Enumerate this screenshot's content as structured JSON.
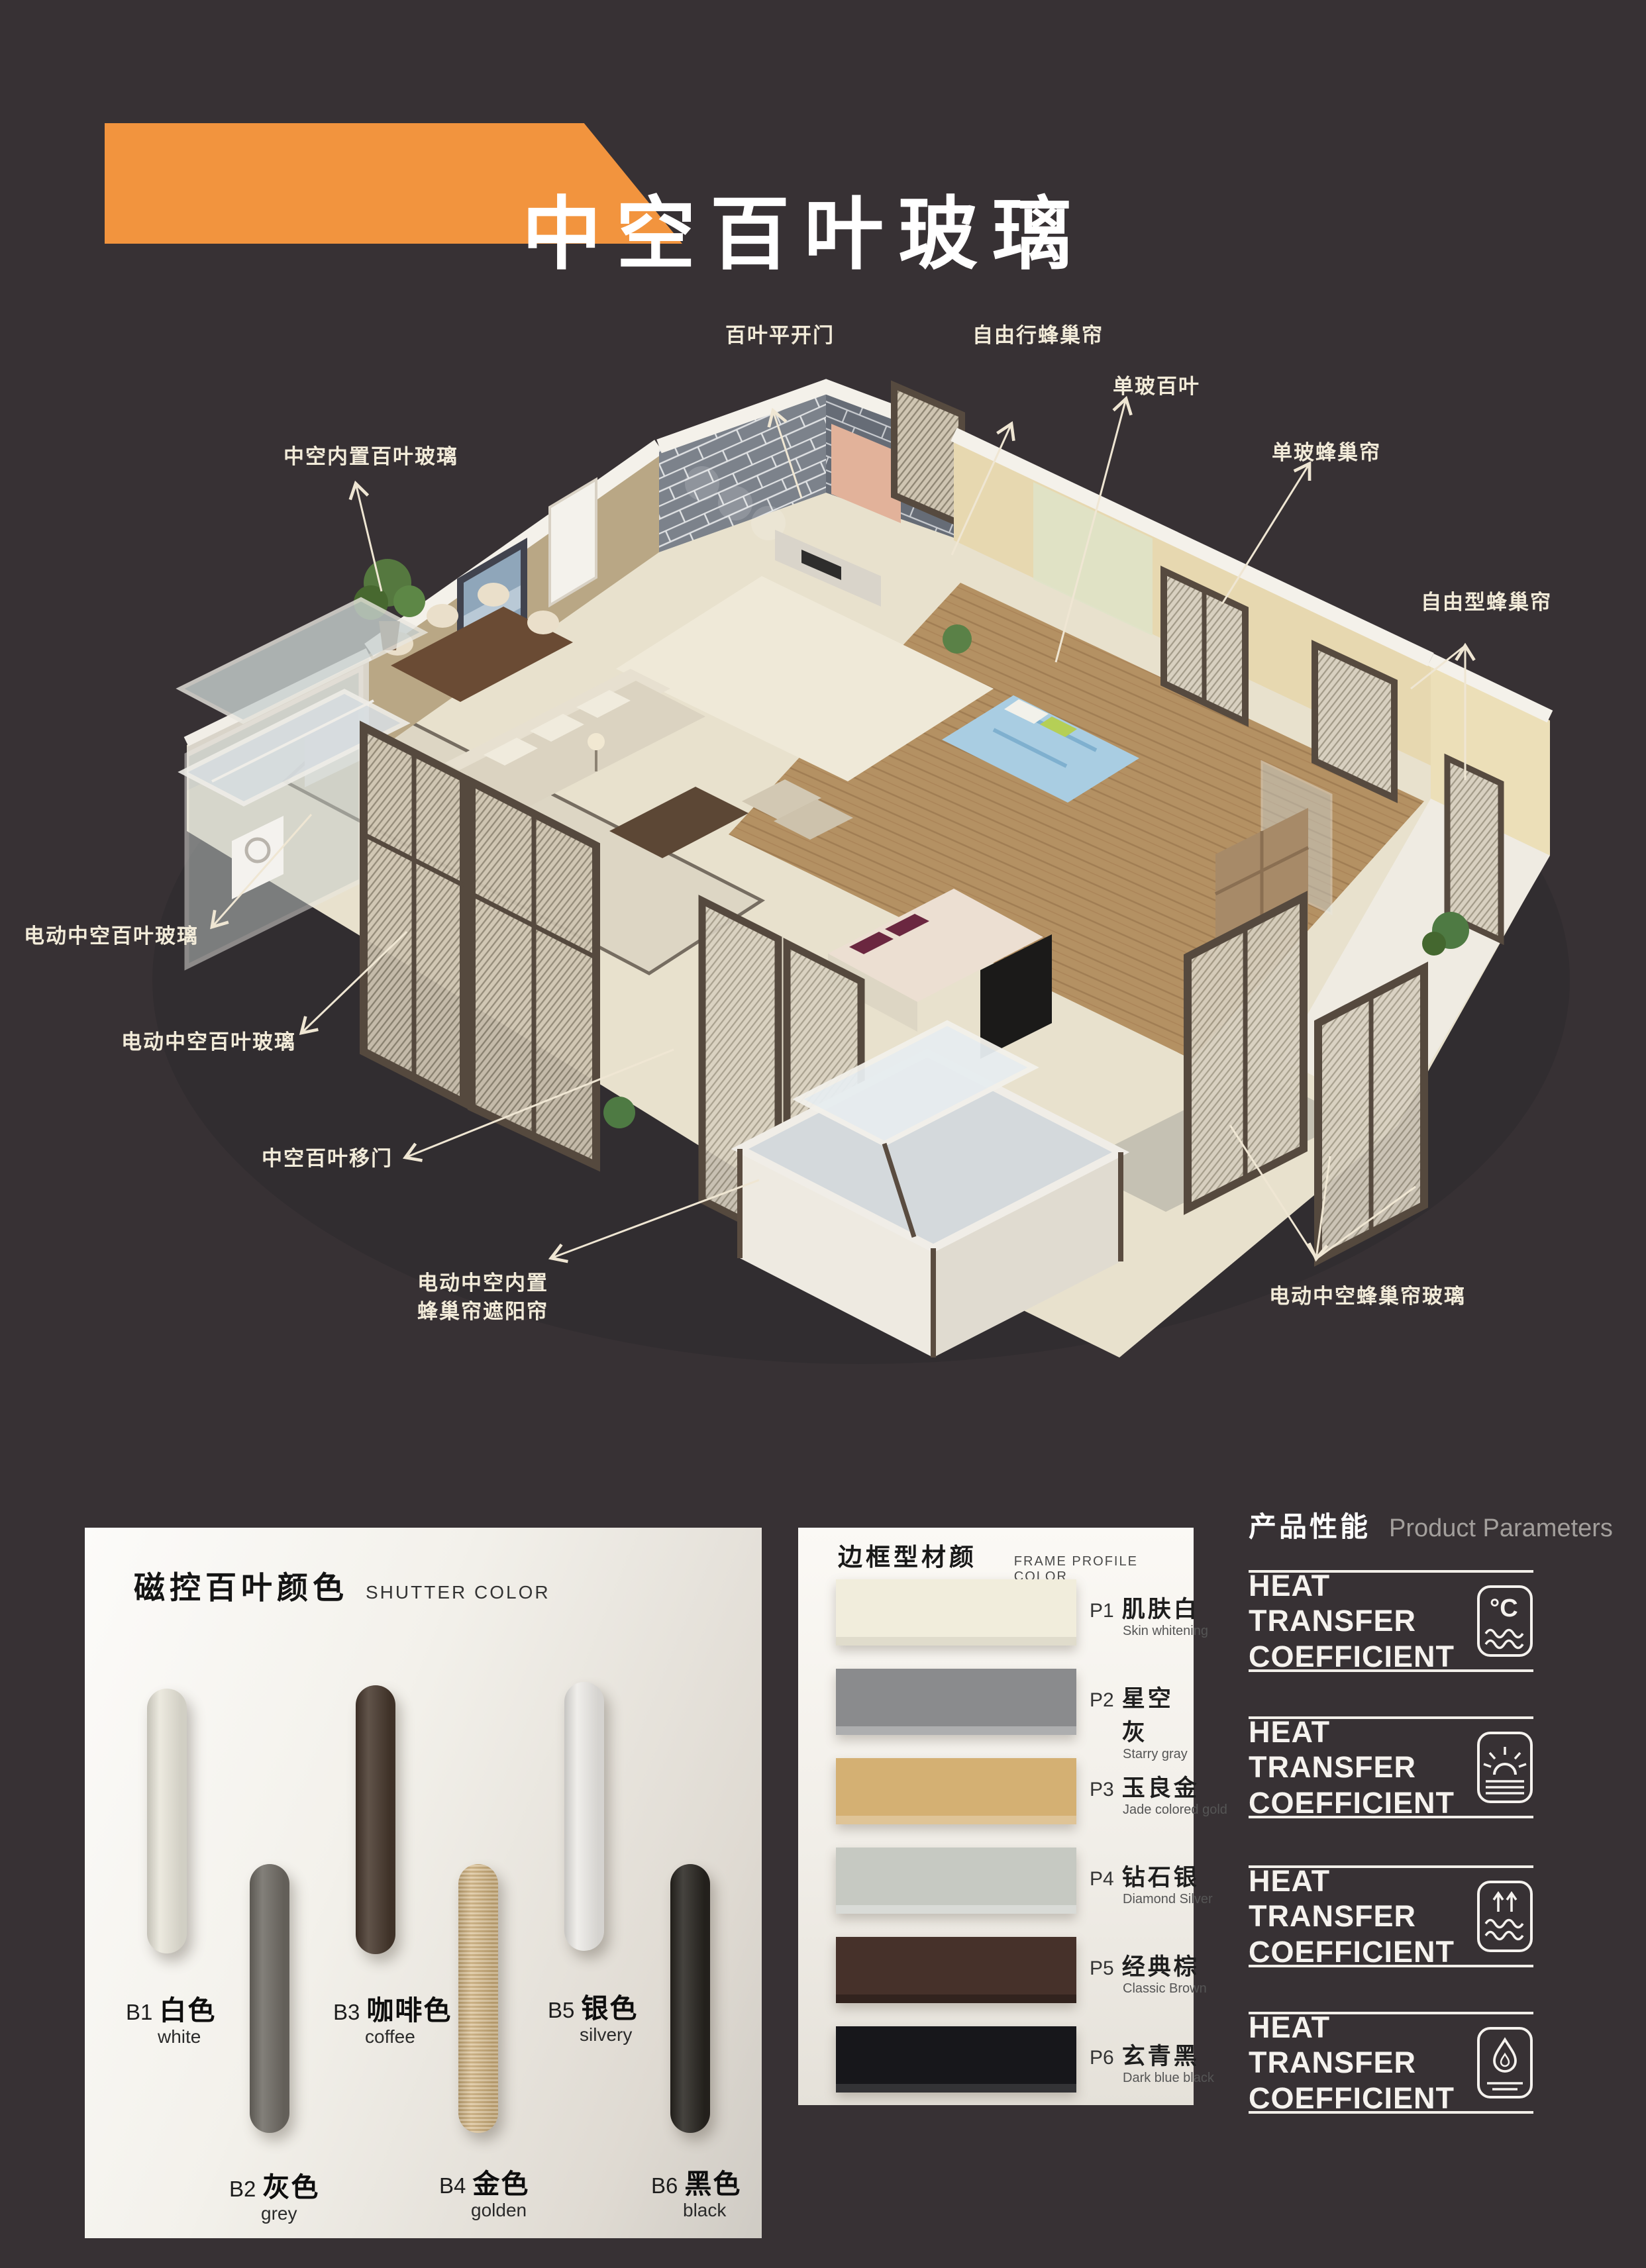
{
  "colors": {
    "background": "#373134",
    "banner_orange": "#f2943e",
    "callout_text": "#f2ebd9",
    "leader_line": "#efe6d3"
  },
  "banner": {
    "title": "中空百叶玻璃"
  },
  "callouts": [
    {
      "label": "百叶平开门"
    },
    {
      "label": "自由行蜂巢帘"
    },
    {
      "label": "单玻百叶"
    },
    {
      "label": "单玻蜂巢帘"
    },
    {
      "label": "中空内置百叶玻璃"
    },
    {
      "label": "自由型蜂巢帘"
    },
    {
      "label": "电动中空百叶玻璃"
    },
    {
      "label": "电动中空百叶玻璃"
    },
    {
      "label": "中空百叶移门"
    },
    {
      "label": "电动中空内置",
      "label2": "蜂巢帘遮阳帘"
    },
    {
      "label": "电动中空蜂巢帘玻璃"
    }
  ],
  "shutter_panel": {
    "title_zh": "磁控百叶颜色",
    "title_en": "SHUTTER COLOR",
    "items": [
      {
        "code": "B1",
        "name_zh": "白色",
        "name_en": "white",
        "color": "#e9e6da"
      },
      {
        "code": "B2",
        "name_zh": "灰色",
        "name_en": "grey",
        "color": "#6e6a63"
      },
      {
        "code": "B3",
        "name_zh": "咖啡色",
        "name_en": "coffee",
        "color": "#46372c"
      },
      {
        "code": "B4",
        "name_zh": "金色",
        "name_en": "golden",
        "color": "#d5b887"
      },
      {
        "code": "B5",
        "name_zh": "银色",
        "name_en": "silvery",
        "color": "#edebe7"
      },
      {
        "code": "B6",
        "name_zh": "黑色",
        "name_en": "black",
        "color": "#27241f"
      }
    ]
  },
  "frame_panel": {
    "title_zh": "边框型材颜色",
    "title_en": "FRAME PROFILE COLOR",
    "items": [
      {
        "code": "P1",
        "name_zh": "肌肤白",
        "name_en": "Skin whitening",
        "color": "#f1eddc"
      },
      {
        "code": "P2",
        "name_zh": "星空灰",
        "name_en": "Starry gray",
        "color": "#8a8b8d"
      },
      {
        "code": "P3",
        "name_zh": "玉良金",
        "name_en": "Jade colored gold",
        "color": "#d4b073"
      },
      {
        "code": "P4",
        "name_zh": "钻石银",
        "name_en": "Diamond Silver",
        "color": "#c6c9c2"
      },
      {
        "code": "P5",
        "name_zh": "经典棕",
        "name_en": "Classic Brown",
        "color": "#46312a"
      },
      {
        "code": "P6",
        "name_zh": "玄青黑",
        "name_en": "Dark blue black",
        "color": "#17171b"
      }
    ]
  },
  "params_panel": {
    "title_zh": "产品性能",
    "title_en": "Product Parameters",
    "rows": [
      {
        "line1": "HEAT TRANSFER",
        "line2": "COEFFICIENT",
        "icon": "celsius-waves"
      },
      {
        "line1": "HEAT TRANSFER",
        "line2": "COEFFICIENT",
        "icon": "sun-horizon"
      },
      {
        "line1": "HEAT TRANSFER",
        "line2": "COEFFICIENT",
        "icon": "arrows-waves"
      },
      {
        "line1": "HEAT TRANSFER",
        "line2": "COEFFICIENT",
        "icon": "water-drop"
      }
    ]
  }
}
